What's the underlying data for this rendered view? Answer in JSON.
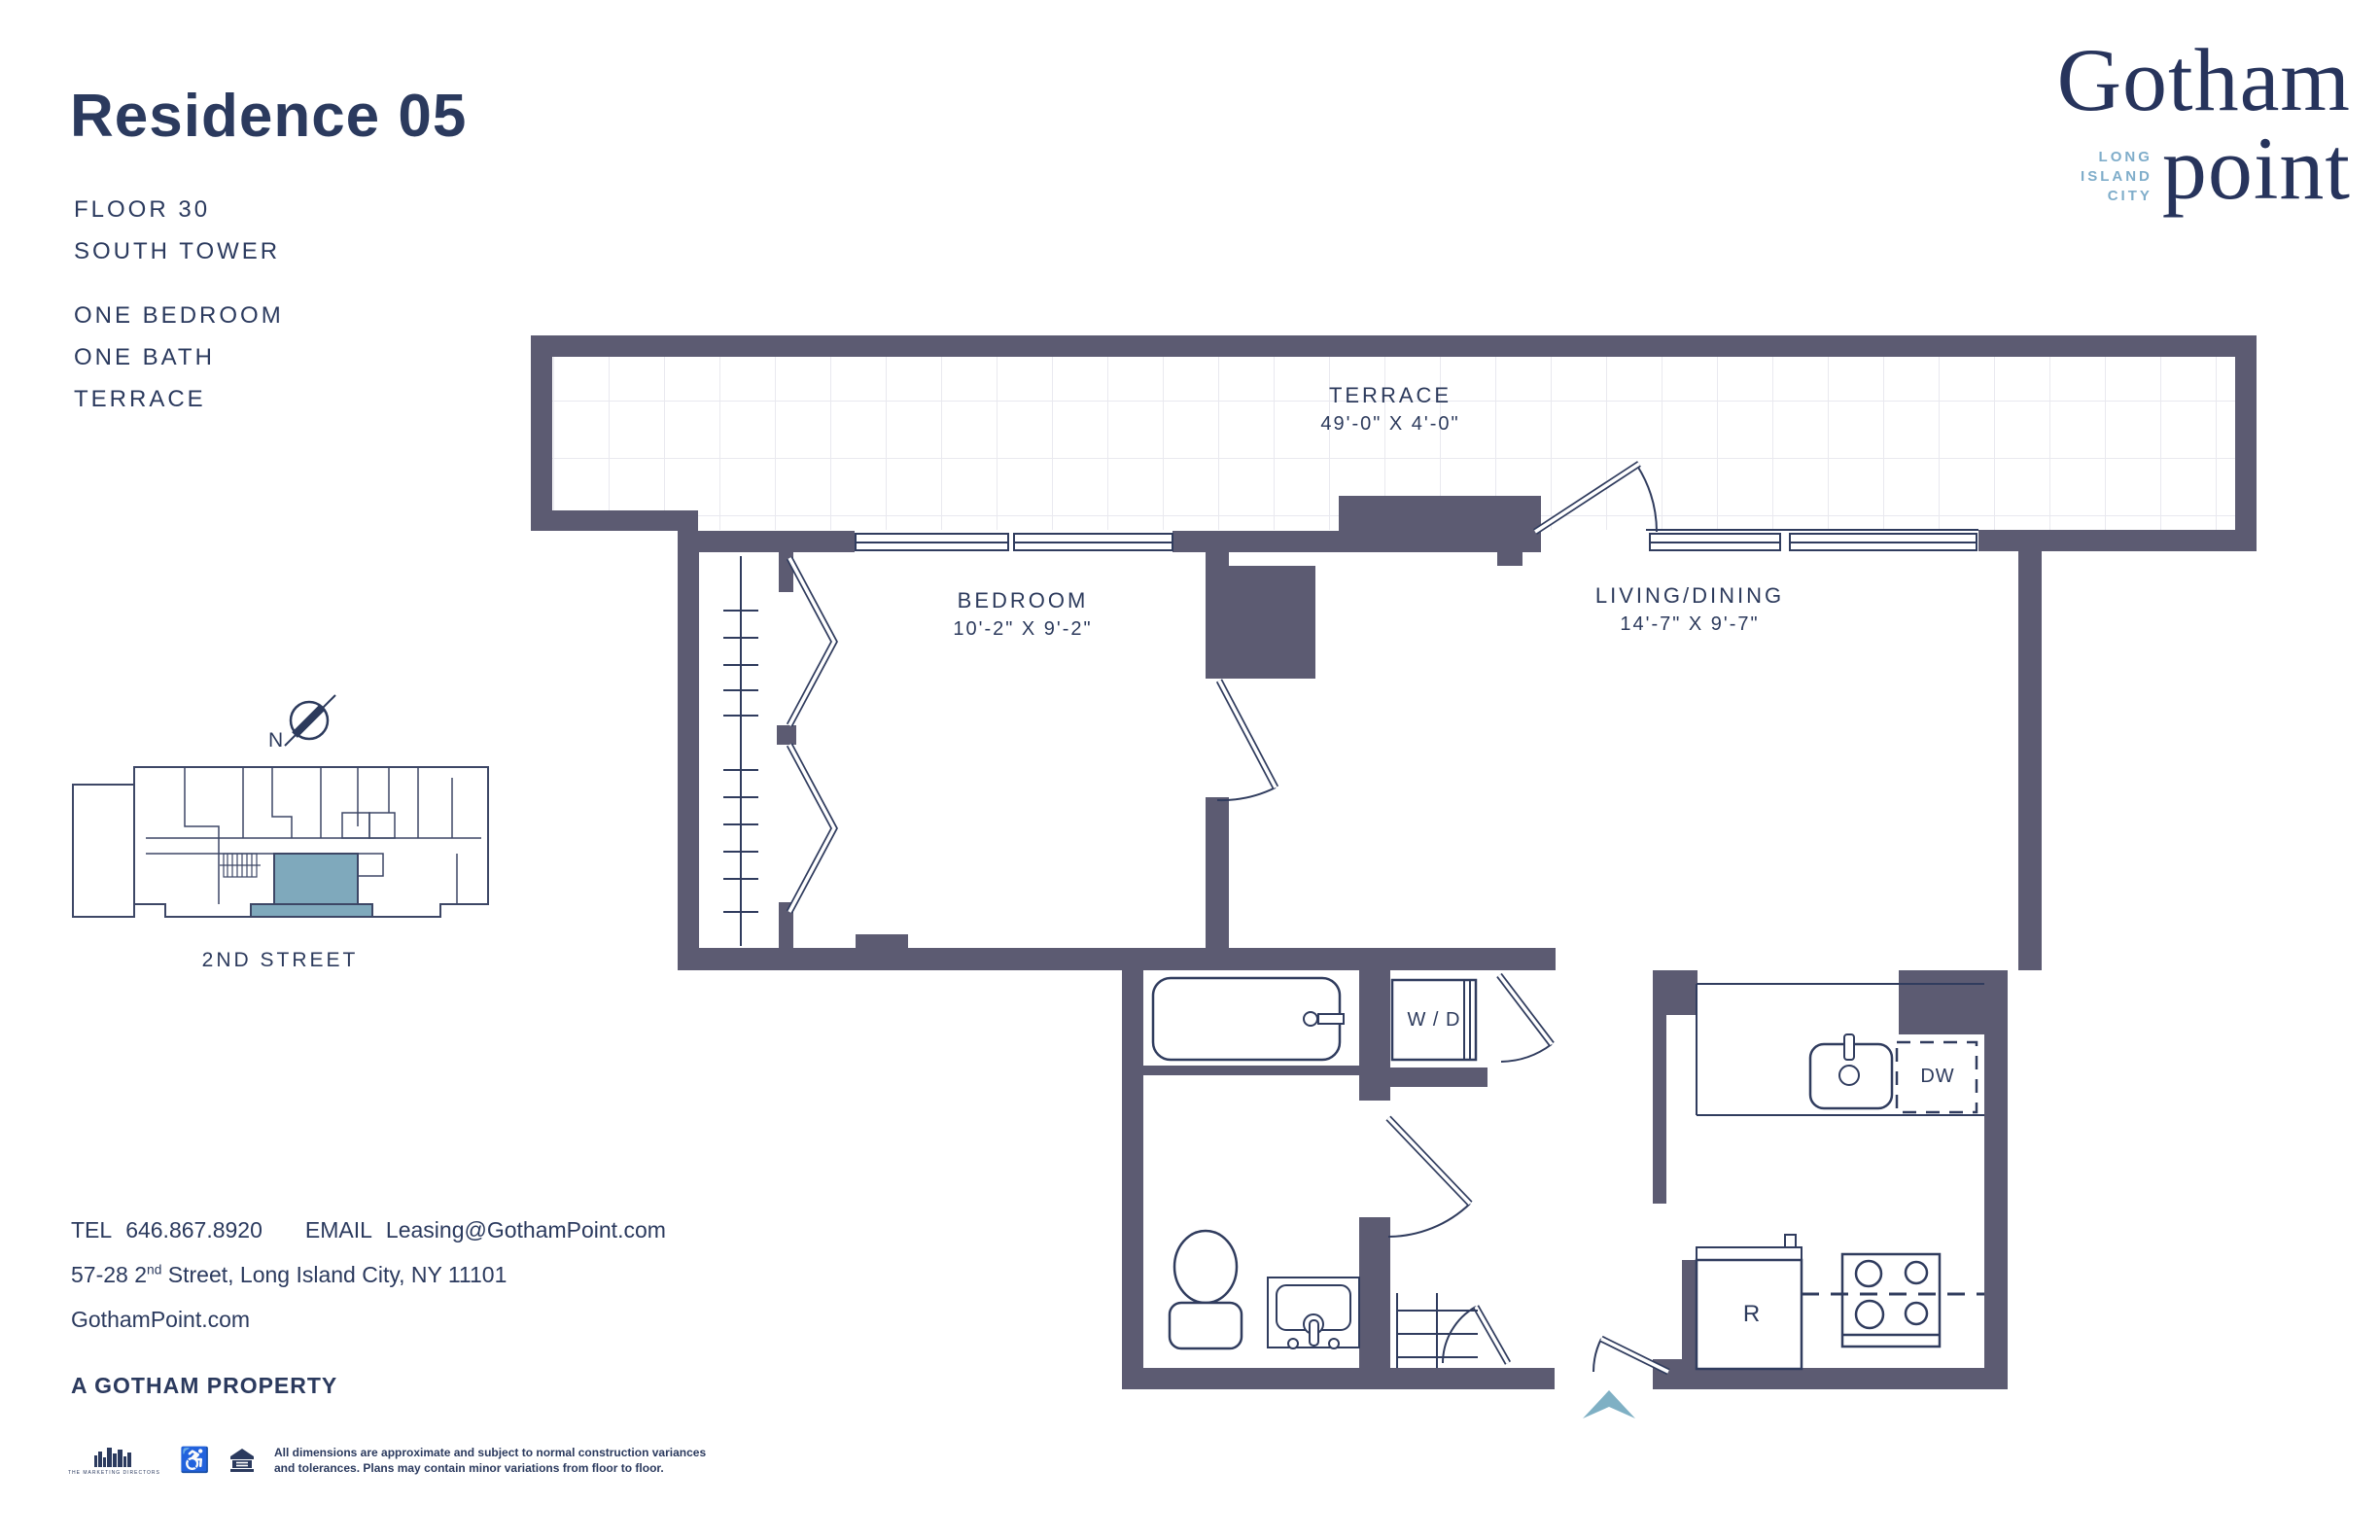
{
  "header": {
    "title": "Residence 05",
    "floor": "FLOOR 30",
    "tower": "SOUTH TOWER",
    "features": [
      "ONE BEDROOM",
      "ONE BATH",
      "TERRACE"
    ]
  },
  "logo": {
    "name_top": "Gotham",
    "name_bottom": "point",
    "loc": [
      "LONG",
      "ISLAND",
      "CITY"
    ]
  },
  "plan": {
    "terrace": {
      "name": "TERRACE",
      "dims": "49'-0\" X 4'-0\""
    },
    "bedroom": {
      "name": "BEDROOM",
      "dims": "10'-2\" X 9'-2\""
    },
    "living": {
      "name": "LIVING/DINING",
      "dims": "14'-7\" X 9'-7\""
    },
    "washer_dryer": "W / D",
    "dishwasher": "DW",
    "refrigerator": "R"
  },
  "keyplan": {
    "street": "2ND STREET",
    "compass_n": "N"
  },
  "contact": {
    "tel_label": "TEL",
    "tel": "646.867.8920",
    "email_label": "EMAIL",
    "email": "Leasing@GothamPoint.com",
    "address_pre": "57-28 2",
    "address_sup": "nd",
    "address_post": " Street, Long Island City, NY 11101",
    "website": "GothamPoint.com",
    "tagline": "A GOTHAM PROPERTY"
  },
  "legal": {
    "line1": "All dimensions are approximate and subject to normal construction variances",
    "line2": "and tolerances. Plans may contain minor variations from floor to floor.",
    "marketing_caption": "THE MARKETING DIRECTORS"
  },
  "colors": {
    "navy": "#2c3a5c",
    "wall": "#5c5b72",
    "accent_blue": "#7fadca",
    "keyplan_highlight": "#7fa9bc",
    "entry_arrow": "#7fb0c4"
  }
}
